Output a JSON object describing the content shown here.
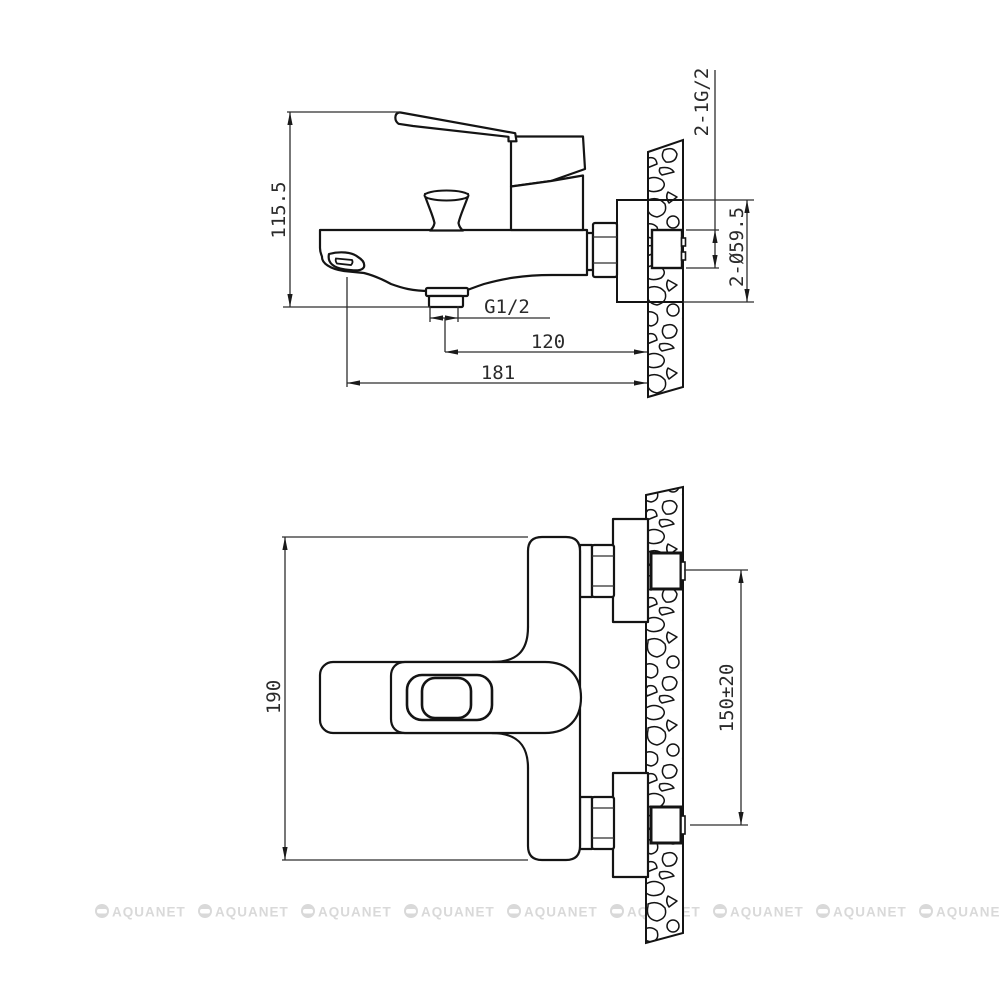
{
  "drawing": {
    "kind": "technical-drawing",
    "product": "wall-mounted bath mixer faucet installation drawing",
    "views": {
      "side": {
        "name": "side view",
        "dimensions": {
          "overall_height": "115.5",
          "outlet_thread": "G1/2",
          "outlet_to_wall": "120",
          "overall_length": "181",
          "wall_thread": "2-1G/2",
          "escutcheon_diameter": "2-Ø59.5"
        }
      },
      "front": {
        "name": "front view",
        "dimensions": {
          "overall_width": "190",
          "connection_spacing": "150±20"
        }
      }
    }
  },
  "watermark": {
    "text": "AQUANET"
  },
  "colors": {
    "line": "#141414",
    "dimension_line": "#2e2e2e",
    "watermark": "#d9d9d9",
    "background": "#ffffff"
  }
}
